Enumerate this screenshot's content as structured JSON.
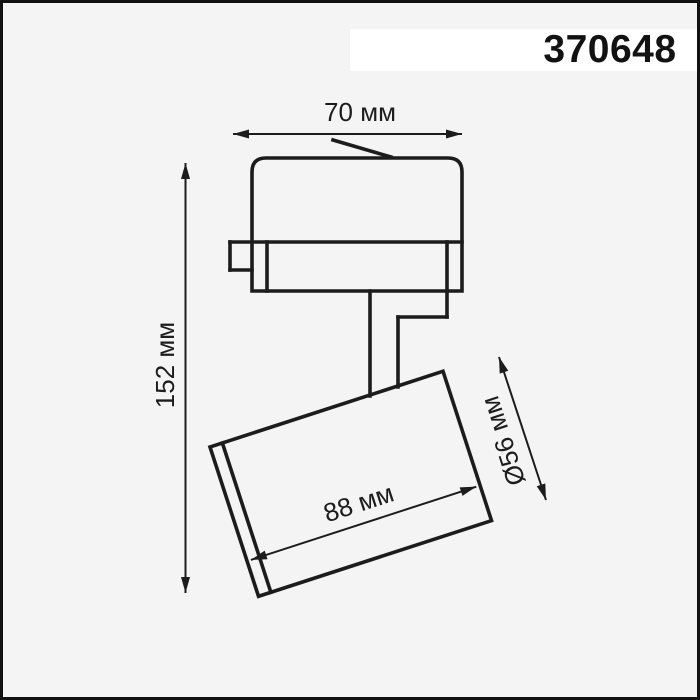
{
  "product": {
    "part_number": "370648"
  },
  "dims": {
    "width": "70 мм",
    "height": "152 мм",
    "length": "88 мм",
    "diameter": "Ø56 мм"
  },
  "colors": {
    "background": "#f4f4f4",
    "line": "#1c1c1c",
    "label_background": "#ffffff",
    "border": "#121212"
  }
}
